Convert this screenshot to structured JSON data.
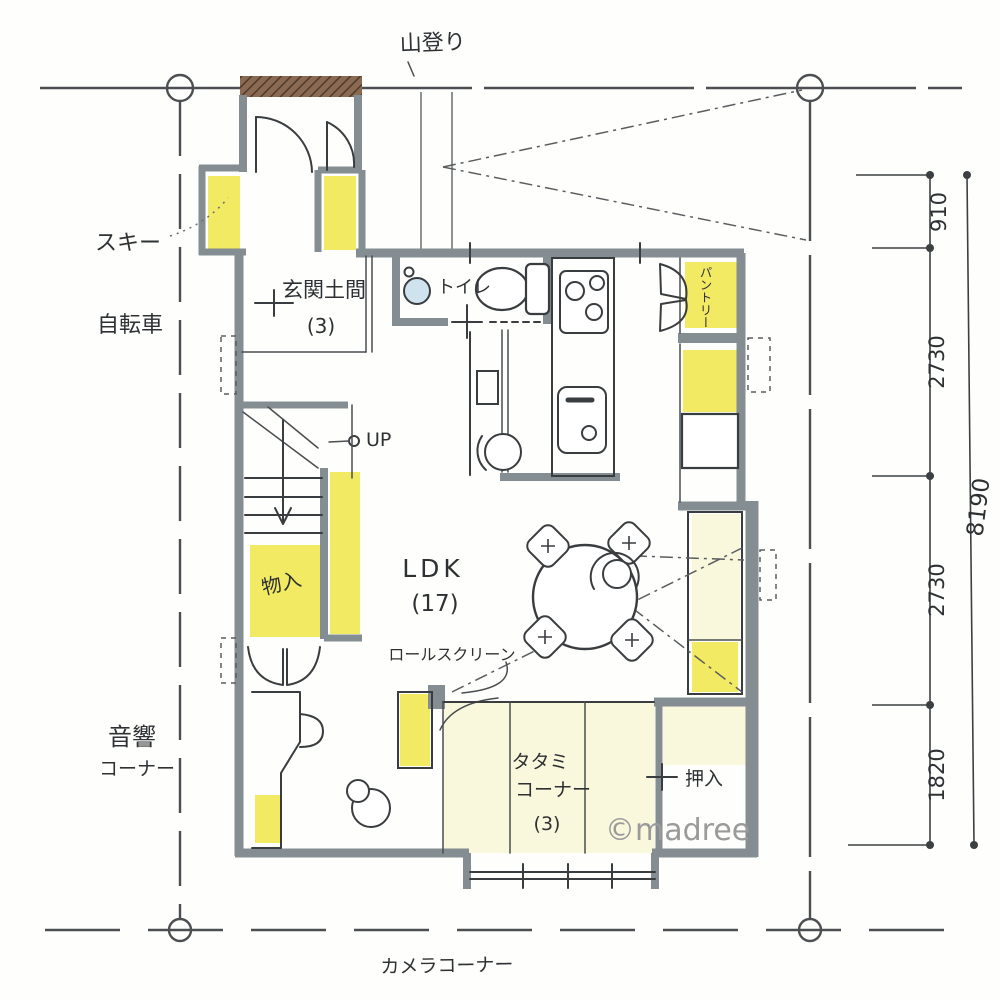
{
  "site": {
    "top": "山登り",
    "bottom": "カメラコーナー"
  },
  "outside": {
    "ski": "スキー",
    "bicycle": "自転車",
    "audio1": "音響",
    "audio2": "コーナー"
  },
  "rooms": {
    "genkan": "玄関土間",
    "genkan_size": "(3)",
    "toilet": "トイレ",
    "ldk": "LDK",
    "ldk_size": "(17)",
    "tatami1": "タタミ",
    "tatami2": "コーナー",
    "tatami_size": "(3)",
    "oshiire": "押入",
    "monoire": "物入",
    "pantry": "パントリー"
  },
  "notes": {
    "up": "UP",
    "roll_screen": "ロールスクリーン"
  },
  "dimensions": {
    "segments": [
      "910",
      "2730",
      "2730",
      "1820"
    ],
    "total": "8190"
  },
  "watermark": "©madree",
  "colors": {
    "highlight": "#f0e647",
    "tatami_tint": "#f7f3cf",
    "wall": "#848d91",
    "pencil": "#3a3d40",
    "boundary": "#4c4f52",
    "hatch_brown": "#6f5643",
    "basin_blue": "#cfe3ee",
    "watermark_gray": "#9a9a9a"
  }
}
